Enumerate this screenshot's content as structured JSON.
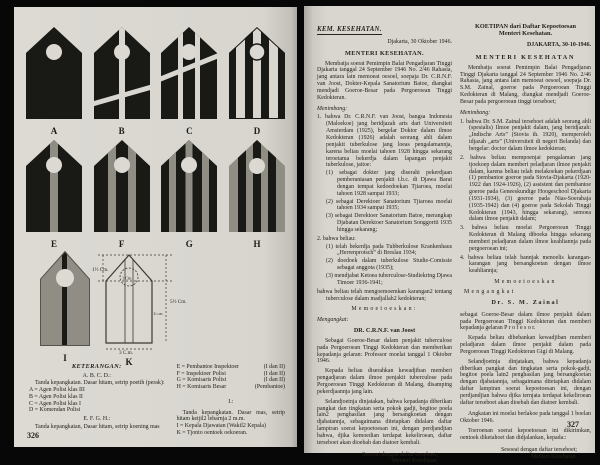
{
  "palette": {
    "page_bg": "#d8d6cf",
    "ink": "#262319",
    "black_badge": "#191915",
    "gold_stripe": "#8f8d84",
    "white_stripe": "#d8d6cf"
  },
  "left_page": {
    "page_number": "326",
    "badges": {
      "row1": [
        {
          "label": "A",
          "base": "hitam",
          "stripes": 0
        },
        {
          "label": "B",
          "base": "hitam",
          "stripes": 1,
          "stripe_color": "poetih"
        },
        {
          "label": "C",
          "base": "hitam",
          "stripes": 2,
          "stripe_color": "poetih"
        },
        {
          "label": "D",
          "base": "hitam",
          "stripes": 3,
          "stripe_color": "poetih"
        }
      ],
      "row2": [
        {
          "label": "E",
          "base": "hitam",
          "stripes": 1,
          "stripe_color": "koening mas"
        },
        {
          "label": "F",
          "base": "hitam",
          "stripes": 2,
          "stripe_color": "koening mas"
        },
        {
          "label": "G",
          "base": "hitam",
          "stripes": 3,
          "stripe_color": "koening mas"
        },
        {
          "label": "H",
          "base": "koening mas",
          "stripes": 3,
          "stripe_color": "hitam"
        }
      ],
      "row3": [
        {
          "label": "I",
          "base": "mas",
          "stripes": 1,
          "stripe_color": "hitam"
        },
        {
          "label": "K",
          "base": "outline"
        }
      ]
    },
    "diagram_k": {
      "top_measure": "1½ Cm.",
      "circle_measure": "1 Cm.",
      "height_measure": "5½ Cm.",
      "inner_height_measure": "4 c.m.",
      "width_measure": "3 C.m."
    },
    "legend": {
      "title": "KETERANGAN:",
      "group_abcd_heading": "A. B. C. D.:",
      "group_abcd_desc": "Tanda kepangkatan. Dasar hitam, setrip poetih (perak):",
      "abcd_items": [
        "A = Agen Polisi klas III",
        "B = Agen Polisi klas II",
        "C = Agen Polisi klas I",
        "D = Komendan Polisi"
      ],
      "group_efgh_heading": "E. F. G. H.:",
      "group_efgh_desc": "Tanda kepangkatan, Dasar hitam, setrip koening mas",
      "efgh_items": [
        {
          "name": "E = Pembantoe Inspektoer",
          "suffix": "(I dan II)"
        },
        {
          "name": "F = Inspektoer Polisi",
          "suffix": "(I dan II)"
        },
        {
          "name": "G = Komisaris Polisi",
          "suffix": "(I dan II)"
        },
        {
          "name": "H = Komisaris Besar",
          "suffix": "(Pembantoe)"
        }
      ],
      "group_i_heading": "I.:",
      "group_i_desc": "Tanda kepangkatan. Dasar mas, setrip hitam ketjil2 lebarnja 2 m.m.",
      "ik_items": [
        "I = Kepala Djawatan (Wakil2 Kepala)",
        "K = Tjonto oentoek oekoeran."
      ]
    }
  },
  "right_page": {
    "page_number": "327",
    "doc1": {
      "header": "KEM. KESEHATAN.",
      "dateline": "Djakarta, 30 Oktober 1946.",
      "title": "MENTERI KESEHATAN.",
      "intro": "Membatja soerat Pemimpin Balai Pengadjaran Tinggi Djakarta tanggal 24 September 1946 No. 2/46 Rahasia, jang antara lain memoeat oesoel, soepaja Dr. C.R.N.F. van Joost, Dokter-Kepala Sanatorium Batoe, diangkat mendjadi Goeroe-Besar pada Pergoeroean Tinggi Kedokteran.",
      "menimbang": "Menimbang:",
      "c1": "1. bahwa Dr. C.R.N.F. van Joost, bangsa Indonesia (Maloekoe) jang beridjazah arts dari Universiteit Amsterdam (1925), bergelar Doktor dalam ilmoe Kedokteran (1926) adalah seorang ahli dalam penjakit tuberkulose jang loeas pengalamannja, karena beliau moelai tahoen 1928 hingga sekarang teroetama bekerdja dalam lapangan penjakit tuberkulose, jaitoe:",
      "c1s": [
        "(1) sebagai dokter jang diserahi pekerdjaan pemberantasan penjakit t.b.c. di Djawa Barat dengan tempat kedoedoekan Tjiaroea, moelai tahoen 1928 sampai 1933;",
        "(2) sebagai Derektoer Sanatorium Tjiaroea moelai tahoen 1934 sampai 1935;",
        "(3) sebagai Derektoer Sanatorium Batoe, merangkap Djabatan Derektoer Sanatorium Songgoriti 1935 hingga sekarang;"
      ],
      "c2": "2. bahwa beliau:",
      "c2s": [
        "(1) telah bekerdja pada Tubberkulose Krankenhaus „Herrenprotsch” di Breslau 1934;",
        "(2) doedoek dalam tuberkulose Studie-Comissie sebagai anggota (1935);",
        "(3) mendjabat Ketoea tuberculose-Studiekring Djawa Timoer 1936-1941;"
      ],
      "c3": "bahwa beliau telah mengoemoemkan karangan2 tentang tuberculose dalam madjallah2 kedokteran;",
      "memoetoeskan": "Memoetoeskan:",
      "mengangkat": "Mengangkat:",
      "name": "DR. C.R.N.F. van Joost",
      "p_appoint": "Sebagai Goeroe-Besar dalam penjakit tuberculose pada Pergoeroean Tinggi Kedokteran dan memberikan kepadanja gelaran: Professor moelai tanggal 1 Oktober 1946.",
      "p_duty": "Kepada beliau diserahkan kewadjiban memberi pengadjaran dalam ilmoe penjakit tuberculose pada Pergoeroean Tinggi Kedokteran di Malang, disamping pekerdjaannja jang lain.",
      "p_salary": "Selandjoetnja dinjatakan, bahwa kepadanja diberikan pangkat dan tingkatan serta pokok gadji, begitoe poela lain2 penghasilan jang bersangkoetan dengan djabatannja, sebagaimana ditetapkan didalam daftar lampiran soerat kepoetoesan ini, dengan perdjandjian bahwa, djika kemoedian terdapat kekeliroean, daftar terseboet akan dioebah dan diatoer kembali.",
      "closing1": "Sesoeai dengan daftar terseboet,",
      "closing2": "Menteri Kesehatan,",
      "signature": "tt. R. Kodijat."
    },
    "doc2": {
      "header1": "KOETIPAN dari Daftar Kepoetoesan",
      "header2": "Menteri Kesehatan.",
      "dateline": "DJAKARTA, 30-10-1946.",
      "title": "MENTERI KESEHATAN",
      "intro": "Membatja soerat Pemimpin Balai Pengadjaran Tinggi Djakarta tanggal 24 September 1946 No. 2/46 Rahasia, jang antara lain memoeat oesoel, soepaja Dr. S.M. Zainal, goeroe pada Pergoeroean Tinggi Kedokteran di Malang, diangkat mendjadi Goeroe-Besar pada pergoeroean tinggi terseboet;",
      "menimbang": "Menimbang:",
      "c1": "1. bahwa Dr. S.M. Zainal terseboet adalah seorang ahli (spesialis) Ilmoe penjakit dalam, jang beridjazah: „Indische Arts” (Stovia th. 1920), memperoleh idjazah „arts” (Universiteit di negeri Belanda) dan bergelar: doctor dalam ilmoe kedokteran;",
      "c2": "2. bahwa beliau mempoenjai pengalaman jang tjoekoep dalam memberi peladjaran ilmoe penjakit dalam, karena beliau telah melakoekan pekerdjaan (1) pembantoe goeroe pada Stovia-Djakarta (1920-1922 dan 1924-1926), (2) assistent dan pembantoe goeroe pada Geneeskundige Hoogeschool Djakarta (1931-1934), (3) goeroe pada Nias-Soerabaja (1935-1942) dan (4) goeroe pada Sekolah Tinggi Kedokteran (1943, hingga sekarang), semoea dalam ilmoe penjakit dalam;",
      "c3": "3. bahwa beliau moelai Pergoeroean Tinggi Kedokteran di Malang diboeka hingga sekarang memberi peladjaran dalam ilmoe keahliannja pada pergoeroean ini;",
      "c4": "4. bahwa beliau telah bannjak menoelis karangan-karangan jang bersangkoetan dengan ilmoe keahliannja;",
      "memoetoeskan": "Memoetoeskan",
      "mengangkat": "Mengangkat",
      "name": "Dr. S. M. Zainal",
      "p_appoint": "sebagai Goeroe-Besar dalam ilmoe penjakit dalam pada Pergoeroean Tinggi Kedokteran dan memberi kepadanja gelaran P r o f e s o r.",
      "p_duty": "Kepada beliau dibebankan kewadjiban memberi peladjaran dalam ilmoe penjakit dalam pada Pergoeroean Tinggi Kedokteran Gigi di Malang.",
      "p_salary": "Selandjoetnja dinjatakan, bahwa kepadanja diberikan pangkat dan tingkatan serta pokok-gadji, begitoe poela lain2 penghasilan jang bersangkoetan dengan djabatannja, sebagaimana ditetapkan didalam daftar lampiran soerat kepoetoesan ini, dengan perdjandjian bahwa djika ternjata terdapat kekeliroean daftar terseboet akan dioebah dan diatoer kembali.",
      "p_effective": "Angkatan ini moelai berlakoe pada tanggal 1 boelan Oktober 1946.",
      "p_copies": "Toeroenan soerat kepoetoesan ini dikirimkan, oentoek diketahoei dan didjalankan, kepada::",
      "closing1": "Sesoeai dengan daftar terseboet;",
      "closing2": "Menteri Kesehatan."
    }
  }
}
